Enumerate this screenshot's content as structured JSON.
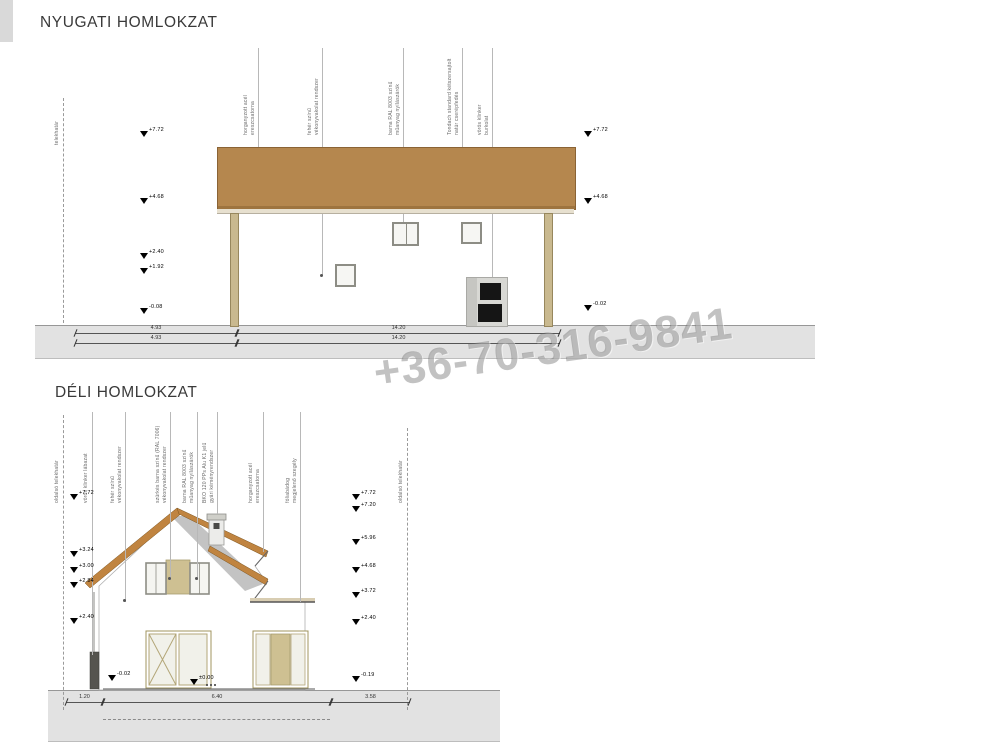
{
  "watermark": "+36-70-316-9841",
  "colors": {
    "roof_brown": "#b5874e",
    "bargeboard_orange": "#c08440",
    "roof_shadow_gray": "#bdbdbd",
    "ground_gray": "#e2e2e2",
    "panel_tan": "#cec092",
    "frame_tan": "#a1945f",
    "window_frame_gray": "#8d8d85"
  },
  "elevation_west": {
    "title": "NYUGATI HOMLOKZAT",
    "boundary_label": "telekhatár",
    "annotations": [
      "horganyzott acél\nereszcsatorna",
      "fehér színű\nvékonyvakolat rendszer",
      "barna RAL 8003 színű\nműanyag nyílászárók",
      "Tondach standard kétszersajtolt\nnatúr cserépfedés",
      "vörös klinker\nburkolat"
    ],
    "levels_left": [
      "+7.72",
      "+4.68",
      "+2.40",
      "+1.92",
      "-0.08"
    ],
    "levels_right": [
      "+7.72",
      "+4.68",
      "-0.02"
    ],
    "dims_row1": [
      "4.93",
      "14.20"
    ],
    "dims_row2": [
      "4.93",
      "14.20"
    ]
  },
  "elevation_south": {
    "title": "DÉLI HOMLOKZAT",
    "boundary_label_left": "oldalsó telekhatár",
    "boundary_label_right": "oldalsó telekhatár",
    "annotations": [
      "vörös klinker lábazat",
      "fehér színű\nvékonyvakolat rendszer",
      "szürkés barna színű (RAL 7006)\nvékonyvakolat rendszer",
      "barna RAL 8003 színű\nműanyag nyílászárók",
      "BKO 120 PPs Alu K1 jelű\ngyári kéményrendszer",
      "horganyzott acél\nereszcsatorna",
      "fóliabádog\nmegjelenő szegély"
    ],
    "levels_left": [
      "+7.72",
      "+3.24",
      "+3.00",
      "+2.84",
      "+2.40"
    ],
    "levels_right": [
      "+7.72",
      "+7.20",
      "+5.96",
      "+4.68",
      "+3.72",
      "+2.40"
    ],
    "levels_bottom": [
      "-0.02",
      "±0.00",
      "-0.19"
    ],
    "dims": [
      "1.20",
      "6.40",
      "3.58"
    ]
  }
}
